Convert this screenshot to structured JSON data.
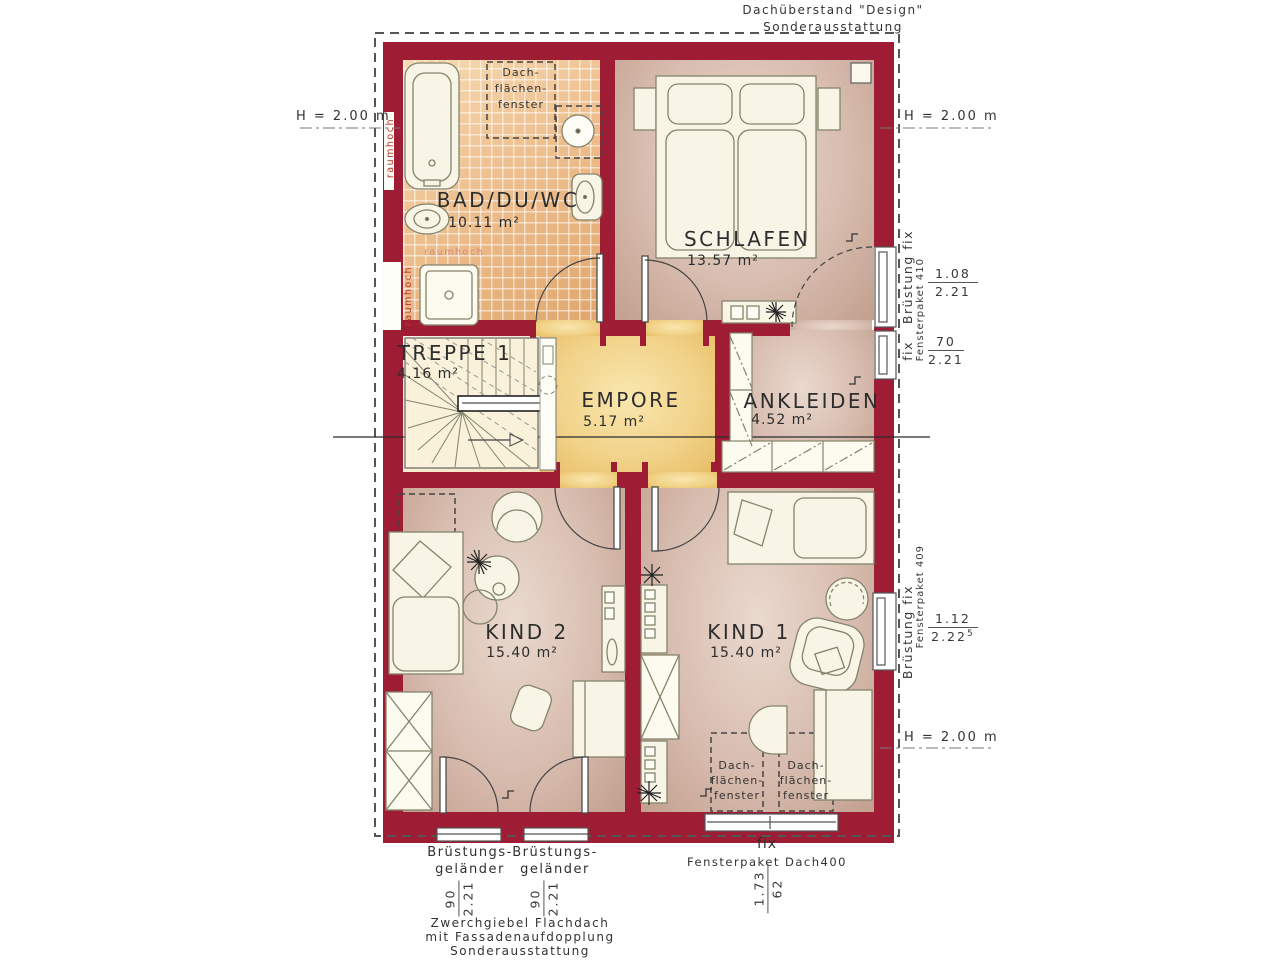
{
  "colors": {
    "wall-red": "#9e1c34",
    "raumhoch-red": "#b8392e",
    "bath-tile": "#eec090",
    "floor-rose": "#d8bdb0",
    "empore-yellow": "#f1d288",
    "furniture-fill": "#f8f5e6",
    "outline": "#84846c"
  },
  "rooms": [
    {
      "name": "BAD/DU/WC",
      "area": "10.11 m²"
    },
    {
      "name": "SCHLAFEN",
      "area": "13.57 m²"
    },
    {
      "name": "TREPPE 1",
      "area": "4.16 m²"
    },
    {
      "name": "EMPORE",
      "area": "5.17 m²"
    },
    {
      "name": "ANKLEIDEN",
      "area": "4.52 m²"
    },
    {
      "name": "KIND 2",
      "area": "15.40 m²"
    },
    {
      "name": "KIND 1",
      "area": "15.40 m²"
    }
  ],
  "labels": {
    "roof_overhang": [
      "Dachüberstand \"Design\"",
      "Sonderausstattung"
    ],
    "height_marks": {
      "left": "H = 2.00 m",
      "right_top": "H = 2.00 m",
      "right_bottom": "H = 2.00 m"
    },
    "skylight_lines": [
      "Dach-",
      "flächen-",
      "fenster"
    ],
    "raumhoch": "raumhoch",
    "gable_note": [
      "Zwerchgiebel Flachdach",
      "mit Fassadenaufdopplung",
      "Sonderausstattung"
    ]
  },
  "windows": {
    "schlafen": {
      "label": "Brüstung fix",
      "package": "Fensterpaket 410",
      "num": "1.08",
      "den": "2.21"
    },
    "ankleiden": {
      "label": "fix",
      "num": "70",
      "den": "2.21"
    },
    "kind1": {
      "label": "Brüstung fix",
      "package": "Fensterpaket 409",
      "num": "1.12",
      "den": "2.22",
      "sup": "5"
    },
    "dach": {
      "label": "fix",
      "package": "Fensterpaket Dach400",
      "num": "1.73",
      "den": "62"
    }
  },
  "railing": {
    "line1": "Brüstungs-",
    "line2": "geländer",
    "num": "90",
    "den": "2.21"
  }
}
